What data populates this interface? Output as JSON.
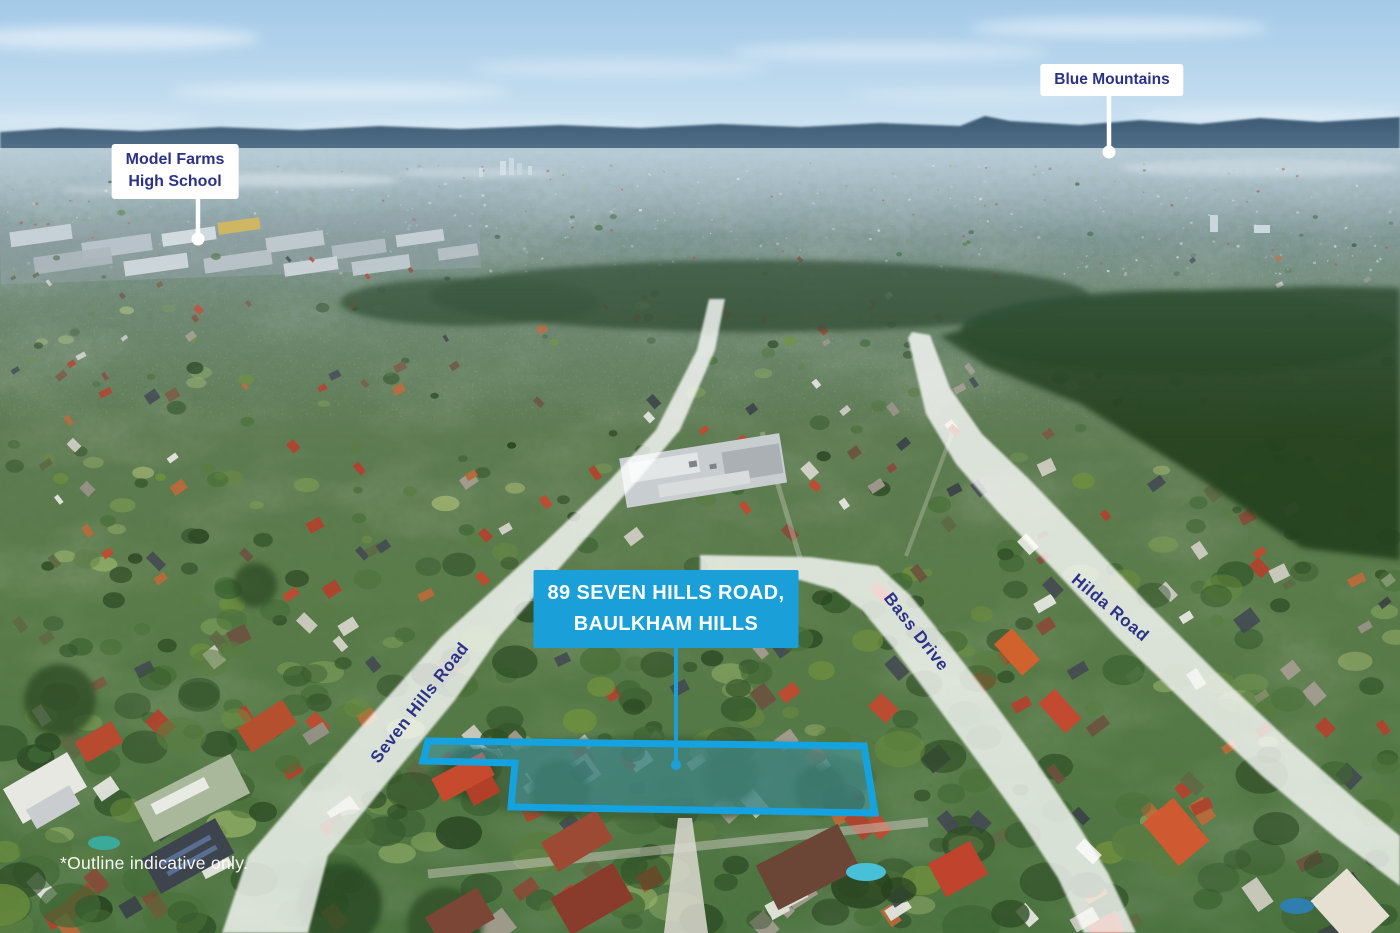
{
  "image_title": "Aerial location photograph with property outline",
  "labels": {
    "blue_mountains": "Blue Mountains",
    "model_farms_line1": "Model Farms",
    "model_farms_line2": "High School",
    "property_line1": "89 SEVEN HILLS ROAD,",
    "property_line2": "BAULKHAM HILLS",
    "road_seven_hills": "Seven Hills Road",
    "road_bass": "Bass Drive",
    "road_hilda": "Hilda Road",
    "disclaimer": "*Outline indicative only."
  },
  "colors": {
    "accent_blue": "#1b9fd8",
    "label_navy": "#2b3287",
    "callout_bg": "#ffffff",
    "outline_stroke": "#14a3e0"
  }
}
